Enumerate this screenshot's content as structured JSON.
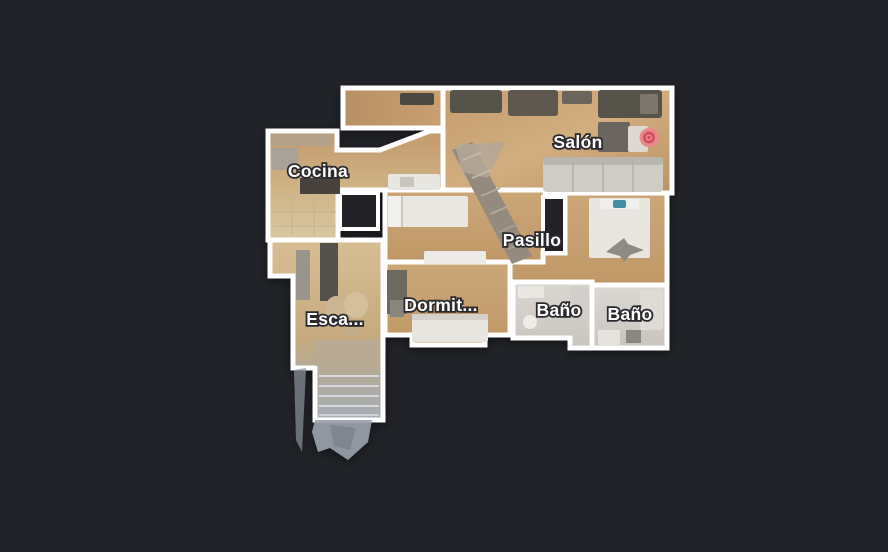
{
  "app": {
    "view_name": "floorplan-view",
    "background_color": "#212328"
  },
  "floorplan": {
    "wall_color": "#ffffff",
    "label_text_color": "#ffffff",
    "label_outline_color": "#2b2b2e",
    "rooms": [
      {
        "id": "cocina",
        "label": "Cocina"
      },
      {
        "id": "salon",
        "label": "Salón"
      },
      {
        "id": "pasillo",
        "label": "Pasillo"
      },
      {
        "id": "dormitorio",
        "label": "Dormit..."
      },
      {
        "id": "bano-1",
        "label": "Baño"
      },
      {
        "id": "bano-2",
        "label": "Baño"
      },
      {
        "id": "escalera",
        "label": "Esca..."
      }
    ],
    "marker": {
      "name": "current-position-marker",
      "outer_color": "#ec878d",
      "ring_color": "#cf4e5b"
    }
  }
}
